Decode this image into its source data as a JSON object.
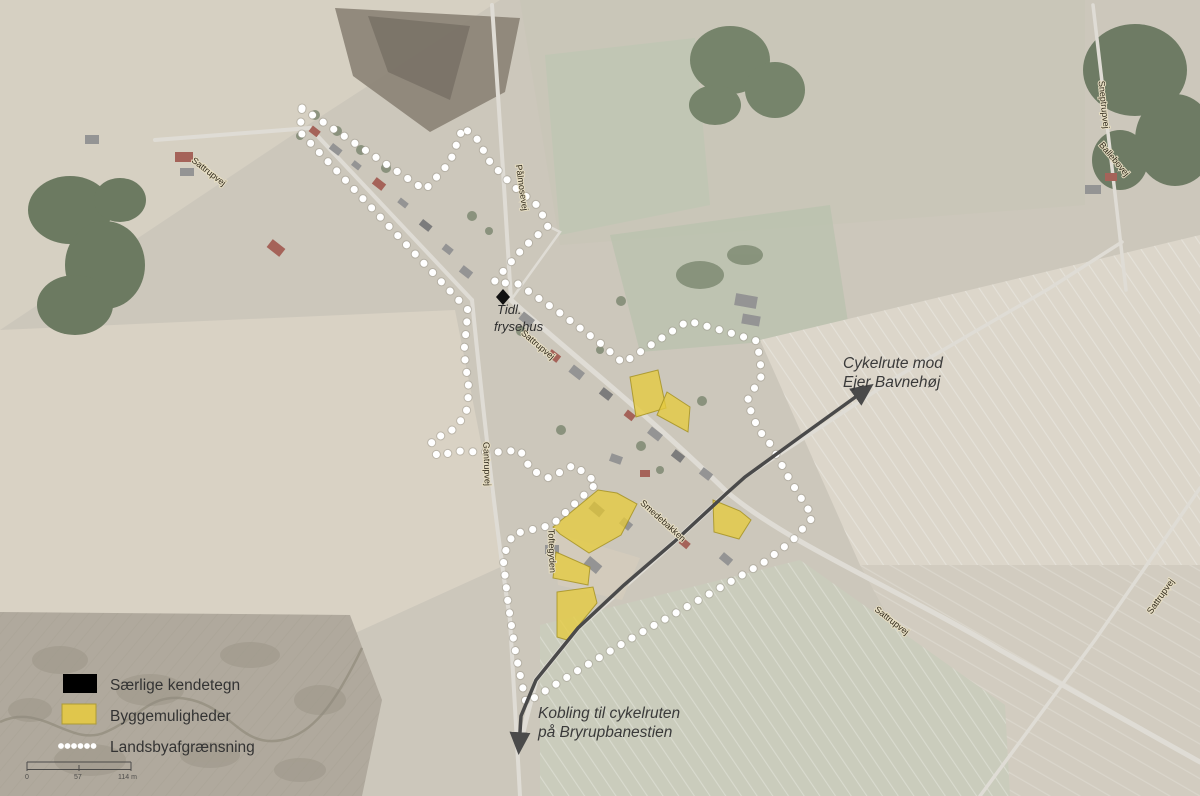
{
  "legend": {
    "items": [
      {
        "label": "Særlige kendetegn",
        "swatch": "black-rect",
        "color": "#000000"
      },
      {
        "label": "Byggemuligheder",
        "swatch": "yellow-rect",
        "color": "#e0c64c"
      },
      {
        "label": "Landsbyafgrænsning",
        "swatch": "white-dotted-line",
        "color": "#ffffff"
      }
    ]
  },
  "annotations": {
    "cycle_route_ne": {
      "line1": "Cykelrute mod",
      "line2": "Ejer Bavnehøj"
    },
    "cycle_route_south": {
      "line1": "Kobling til cykelruten",
      "line2": "på Bryrupbanestien"
    },
    "landmark": {
      "line1": "Tidl.",
      "line2": "frysehus"
    }
  },
  "road_labels": [
    {
      "id": "nw-road",
      "text": "Sattrupvej"
    },
    {
      "id": "north-lane",
      "text": "Pålmosevej"
    },
    {
      "id": "village-center",
      "text": "Sattrupvej"
    },
    {
      "id": "south-arm",
      "text": "Gantrupvej"
    },
    {
      "id": "dev-area-lane",
      "text": "Toftegyden"
    },
    {
      "id": "village-se-lane",
      "text": "Smedebakken"
    },
    {
      "id": "se-road",
      "text": "Sattrupvej"
    },
    {
      "id": "far-east-road",
      "text": "Sattrupvej"
    },
    {
      "id": "ne-top-road",
      "text": "Sneptrupvej"
    },
    {
      "id": "ne-top-road2",
      "text": "Ballebovej"
    }
  ],
  "scale_bar": {
    "start": "0",
    "middle": "57",
    "end": "114 m"
  },
  "map_colors": {
    "boundary_dots": "#ffffff",
    "building_opportunity": "#e6cb3f",
    "route_line": "#4a4a4a"
  }
}
